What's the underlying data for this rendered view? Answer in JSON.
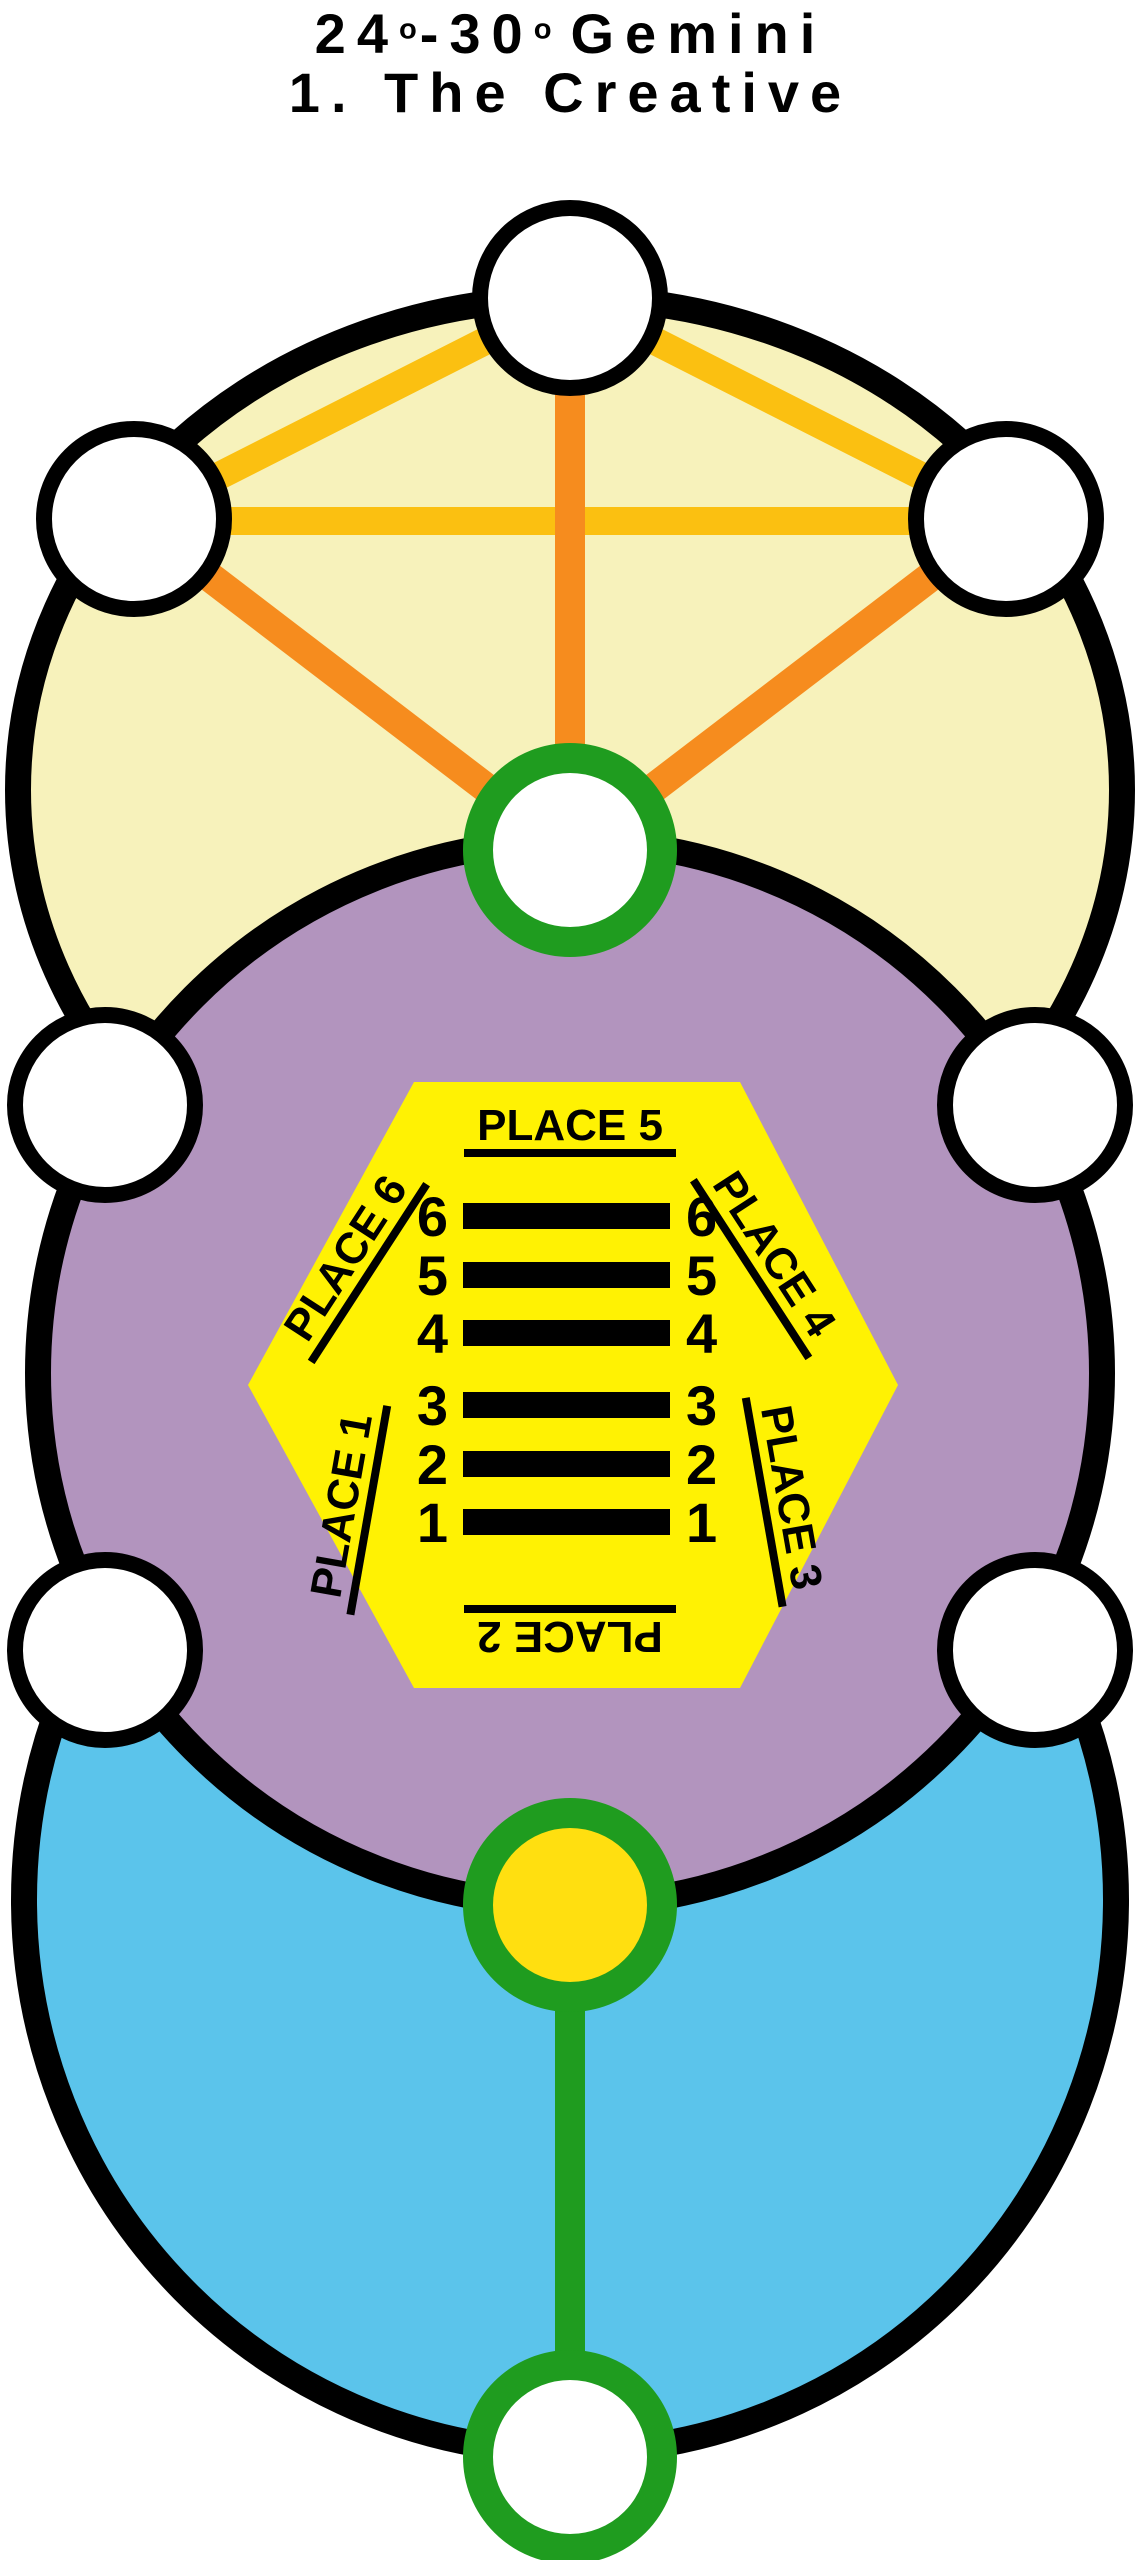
{
  "title": {
    "degree_start": "24",
    "degree_symbol": "o",
    "separator": "-",
    "degree_end": "30",
    "zodiac_sign": "Gemini",
    "hexagram_name": "1. The Creative"
  },
  "hexagon": {
    "place_labels": {
      "top": "PLACE 5",
      "upper_left": "PLACE 6",
      "upper_right": "PLACE 4",
      "lower_left": "PLACE 1",
      "lower_right": "PLACE 3",
      "bottom": "PLACE 2"
    }
  },
  "hexagram": {
    "lines": [
      {
        "position": 6,
        "type": "solid"
      },
      {
        "position": 5,
        "type": "solid"
      },
      {
        "position": 4,
        "type": "solid"
      },
      {
        "position": 3,
        "type": "solid"
      },
      {
        "position": 2,
        "type": "solid"
      },
      {
        "position": 1,
        "type": "solid"
      }
    ]
  },
  "colors": {
    "cream": "#F7F2BB",
    "purple": "#B294BE",
    "blue": "#5BC4EB",
    "hexagon_yellow": "#FFF203",
    "node_yellow": "#FFDF10",
    "gold_line": "#FBC011",
    "orange_line": "#F68C1E",
    "green": "#1F9C1F",
    "outline_black": "#000000",
    "node_white": "#FFFFFF"
  }
}
